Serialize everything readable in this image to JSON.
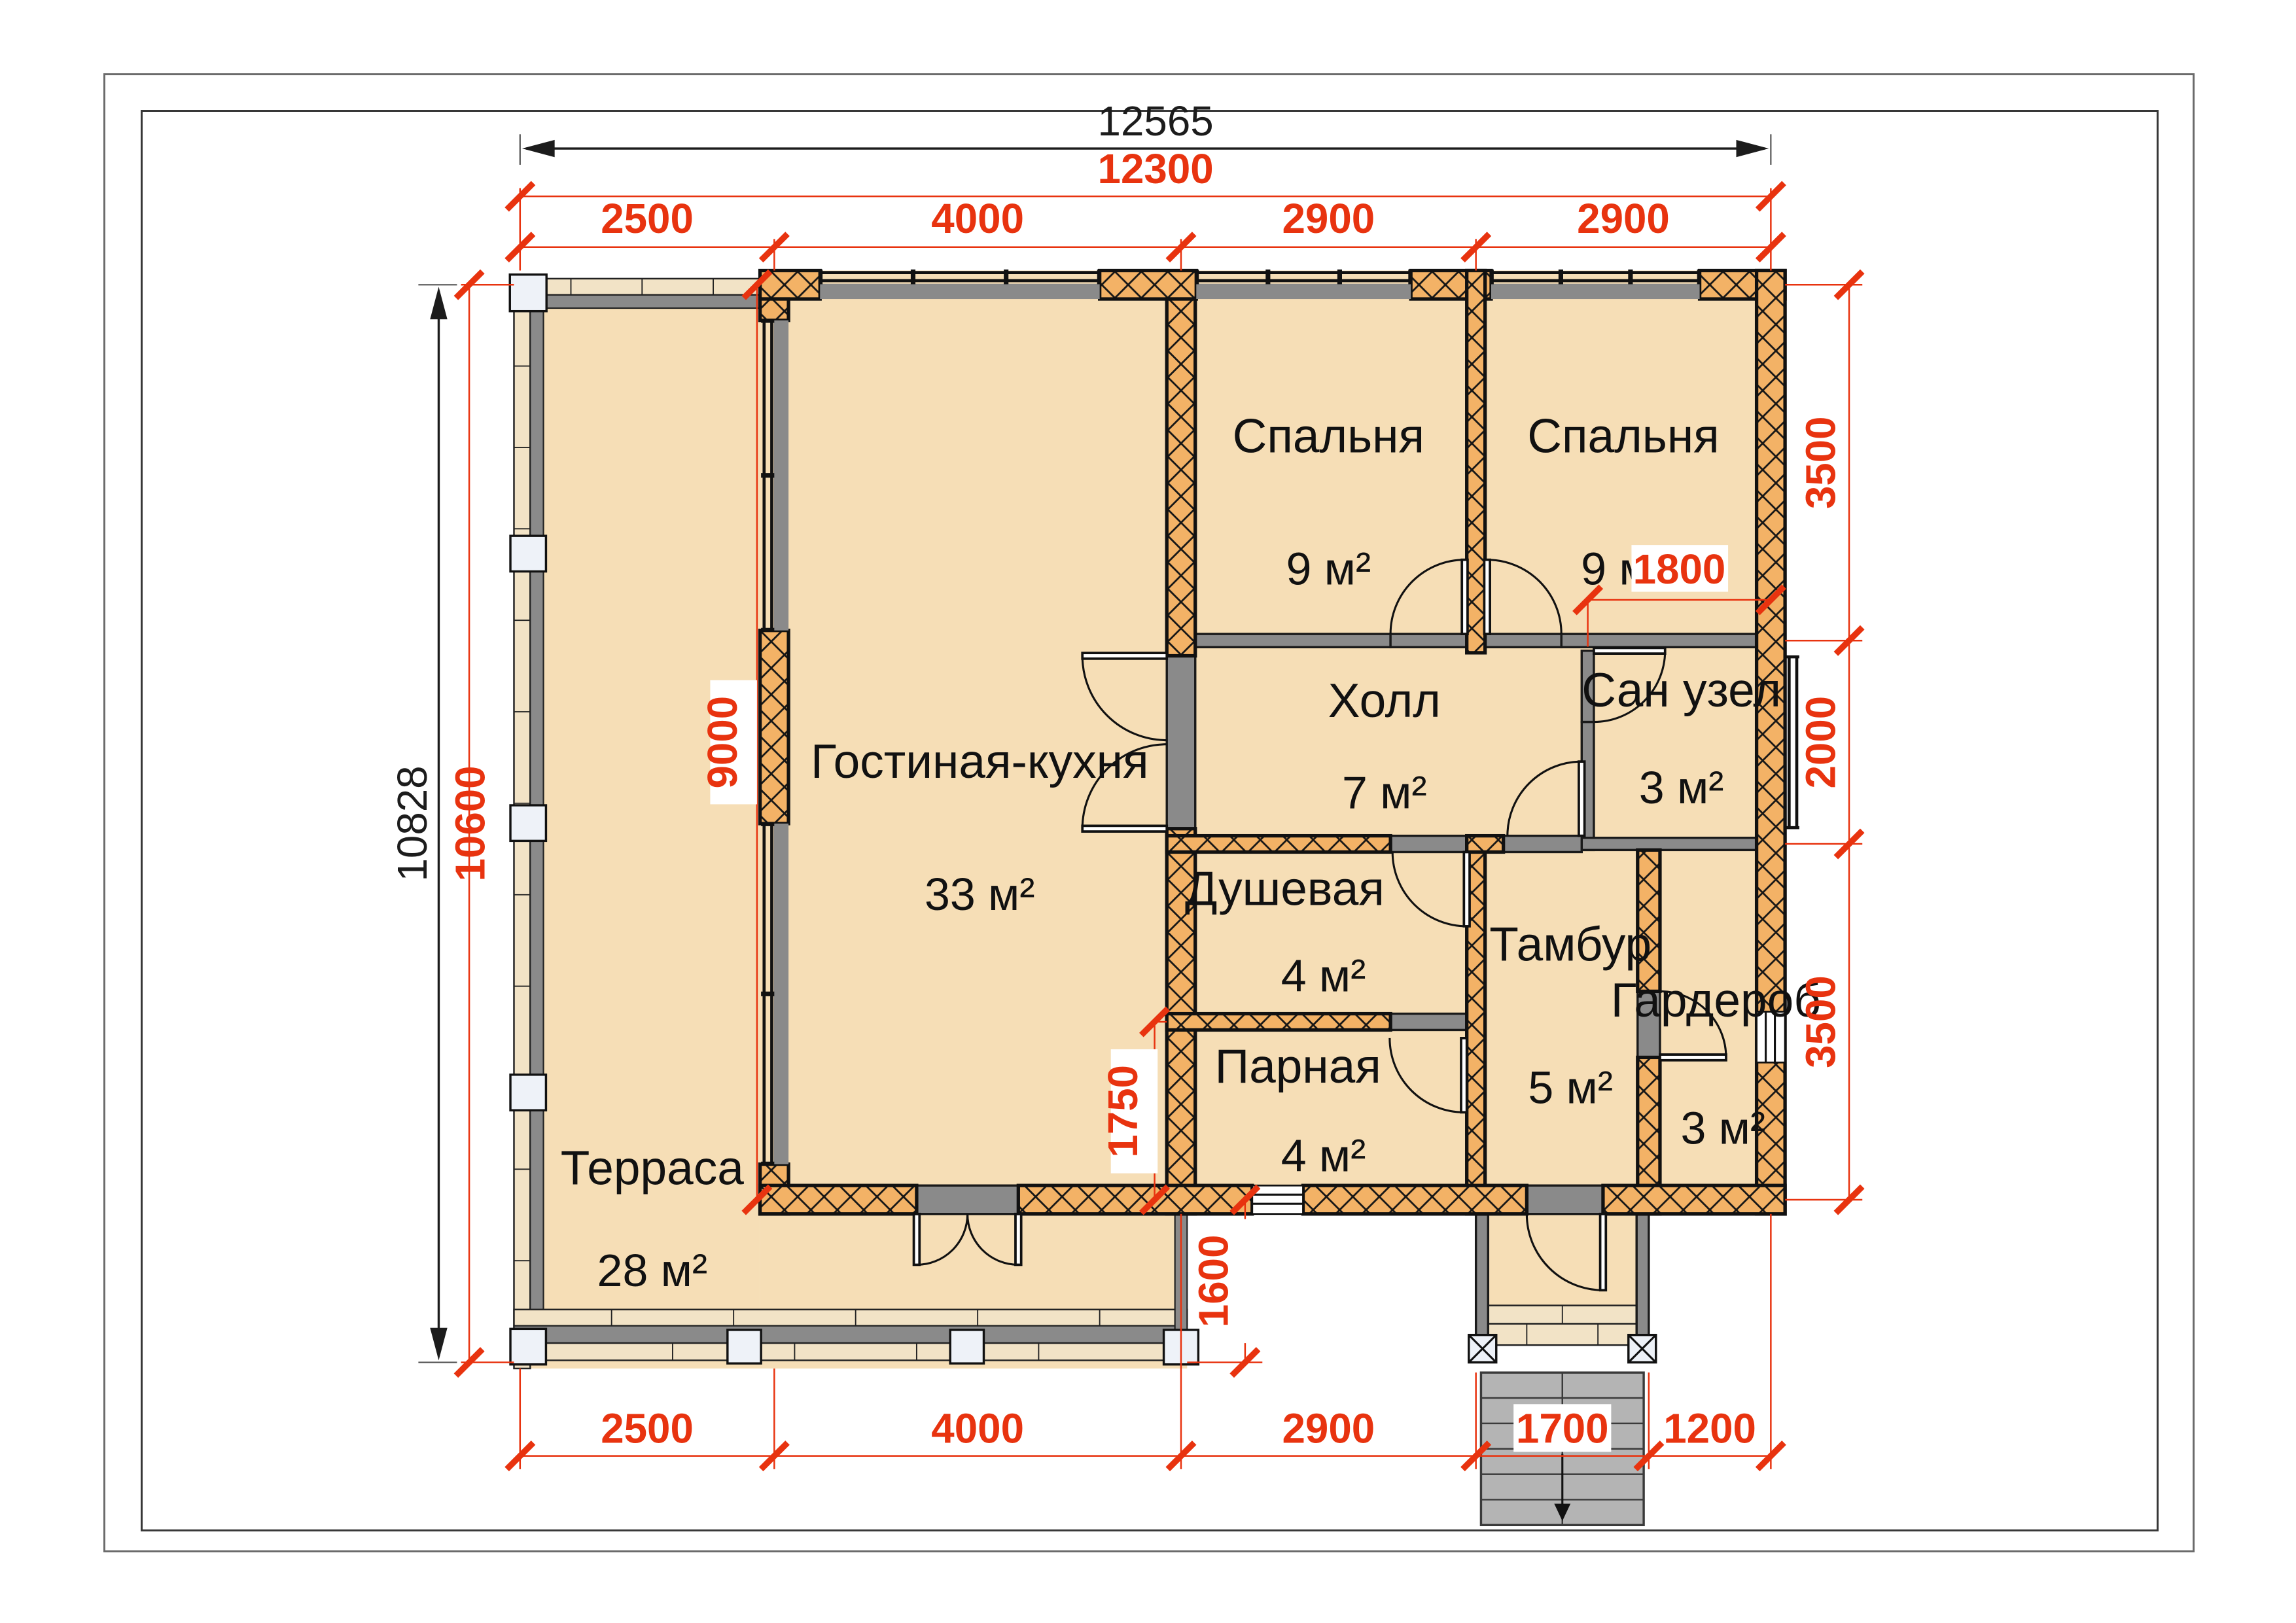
{
  "title": "floor-plan",
  "rooms": [
    {
      "id": "terrace",
      "name": "Терраса",
      "area": "28 м²"
    },
    {
      "id": "living",
      "name": "Гостиная-кухня",
      "area": "33 м²"
    },
    {
      "id": "bedroom1",
      "name": "Спальня",
      "area": "9 м²"
    },
    {
      "id": "bedroom2",
      "name": "Спальня",
      "area": "9 м²"
    },
    {
      "id": "hall",
      "name": "Холл",
      "area": "7 м²"
    },
    {
      "id": "sanuzel",
      "name": "Сан узел",
      "area": "3 м²"
    },
    {
      "id": "shower",
      "name": "Душевая",
      "area": "4 м²"
    },
    {
      "id": "parnaya",
      "name": "Парная",
      "area": "4 м²"
    },
    {
      "id": "tambur",
      "name": "Тамбур",
      "area": "5 м²"
    },
    {
      "id": "garderob",
      "name": "Гардероб",
      "area": "3 м²"
    }
  ],
  "dims": {
    "top_overall": "12565",
    "top_axis": "12300",
    "left_overall": "10828",
    "left_axis": "10600",
    "top_segments": [
      "2500",
      "4000",
      "2900",
      "2900"
    ],
    "bottom_segments": [
      "2500",
      "4000",
      "2900",
      "1700",
      "1200"
    ],
    "right_segments": [
      "3500",
      "2000",
      "3500"
    ],
    "inner": {
      "terrace_depth": "9000",
      "sanuzel_offset": "1800",
      "parnaya_height": "1750",
      "deck_height": "1600"
    }
  },
  "colors": {
    "dim_red": "#e8330f",
    "wall_hatch": "#f3b266",
    "room_fill": "#f6deb6",
    "partition": "#8a8a8a"
  }
}
